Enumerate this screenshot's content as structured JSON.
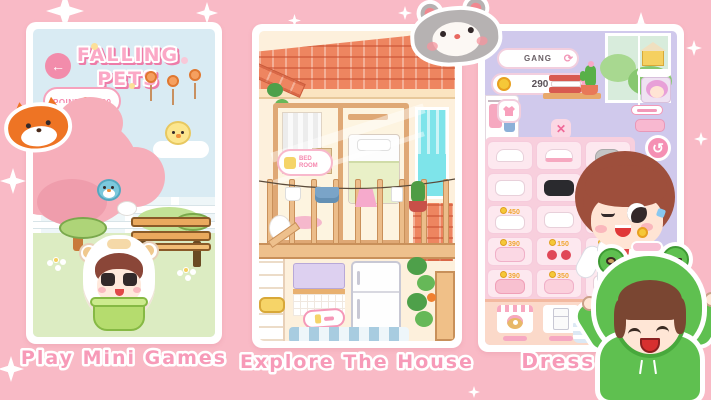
{
  "panels": {
    "left": {
      "caption": "Play Mini Games",
      "title_line1": "FALLING",
      "title_line2": "PETS",
      "points": "POINTS: 1520",
      "icons": {
        "back": "←"
      }
    },
    "middle": {
      "caption": "Explore The House",
      "room_label_line1": "BED",
      "room_label_line2": "ROOM"
    },
    "right": {
      "caption": "Dress Up",
      "player_name": "GANG",
      "coin_balance": "290",
      "prices": [
        "450",
        "390",
        "150",
        "150",
        "390",
        "350"
      ],
      "icons": {
        "refresh": "⟳",
        "close": "✕",
        "rotate": "↺",
        "flower": "✿"
      }
    }
  },
  "stickers": {
    "fox": "fox-sticker",
    "hamster": "hamster-sticker",
    "frog_kid": "frog-hoodie-kid-sticker"
  },
  "colors": {
    "background": "#f9bac6",
    "caption_pink": "#f587ae",
    "panel_frame": "#ffffff",
    "sky_blue": "#d9ebf3",
    "grass_green": "#dcecc2",
    "lavender": "#d0c9ec",
    "roof_orange": "#ee8560",
    "frog_green": "#5fc050",
    "coin_gold": "#f5c838",
    "accent_pink": "#f28cab"
  }
}
